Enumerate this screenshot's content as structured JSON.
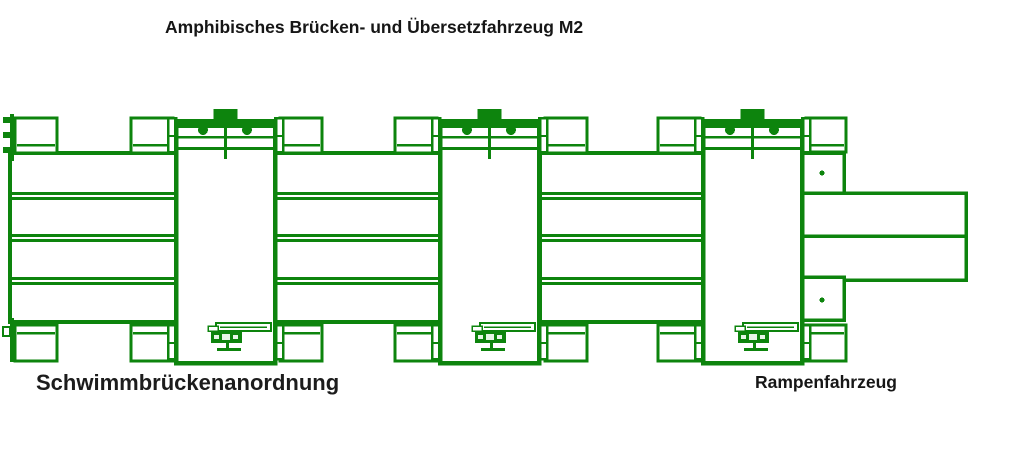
{
  "title": "Amphibisches Brücken- und Übersetzfahrzeug M2",
  "captions": {
    "bridge_arrangement": "Schwimmbrückenanordnung",
    "ramp_vehicle": "Rampenfahrzeug"
  },
  "colors": {
    "diagram_green": "#0d840d",
    "text": "#161616",
    "background": "#ffffff"
  },
  "diagram": {
    "canvas": {
      "width": 1024,
      "height": 456
    },
    "vehicles": {
      "xs": [
        176,
        440,
        703
      ],
      "width": 99,
      "top": 121,
      "height": 242,
      "cab": {
        "w": 24,
        "h": 14,
        "y": 109
      },
      "row_line1_y": 136,
      "row_line2_y": 147,
      "circle_offsets": [
        27,
        71
      ],
      "circle_cy": 130,
      "circle_r": 5,
      "mech": {
        "boom_y": 323,
        "winch_y": 332,
        "stand_y": 343
      }
    },
    "decks": [
      {
        "x1": 10,
        "x2": 176,
        "edge_tabs": true
      },
      {
        "x1": 275,
        "x2": 440,
        "edge_tabs": false
      },
      {
        "x1": 540,
        "x2": 703,
        "edge_tabs": false
      }
    ],
    "deck": {
      "top": 153,
      "height": 169,
      "divider_ys": [
        192,
        234,
        277
      ],
      "pontoon": {
        "w": 42,
        "top_y": 118,
        "top_h": 35,
        "bot_y": 325,
        "bot_h": 36
      }
    },
    "ramp": {
      "x": 798,
      "box_w": 46,
      "ramp_x2": 966,
      "upper_box_y": 153,
      "ramp1_y": 193,
      "ramp2_y": 236,
      "lower_box_y": 277,
      "lower_box_end": 320,
      "pontoon": {
        "x": 806,
        "w": 40,
        "top_y": 118,
        "top_h": 34,
        "bot_y": 325,
        "bot_h": 36
      },
      "dots": [
        {
          "cx": 822,
          "cy": 173
        },
        {
          "cx": 822,
          "cy": 300
        }
      ],
      "dot_r": 2.5
    }
  }
}
